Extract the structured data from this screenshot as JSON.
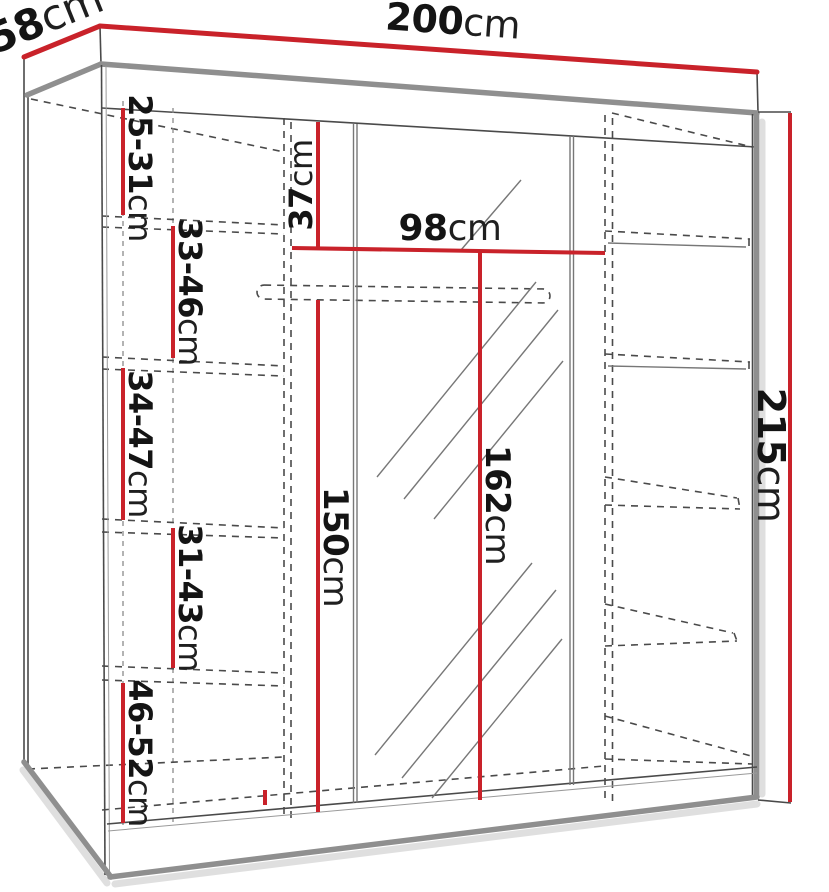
{
  "diagram": {
    "type": "wardrobe-dimension-diagram",
    "accent_color": "#c9222a",
    "line_color": "#141414"
  },
  "labels": {
    "width": {
      "num": "200",
      "unit": "cm"
    },
    "depth": {
      "num": "58",
      "unit": "cm"
    },
    "height": {
      "num": "215",
      "unit": "cm"
    },
    "top_gap": {
      "num": "37",
      "unit": "cm"
    },
    "rod_width": {
      "num": "98",
      "unit": "cm"
    },
    "left_height": {
      "num": "150",
      "unit": "cm"
    },
    "rod_height": {
      "num": "162",
      "unit": "cm"
    },
    "shelf_gap_1": {
      "num": "25-31",
      "unit": "cm"
    },
    "shelf_gap_2": {
      "num": "33-46",
      "unit": "cm"
    },
    "shelf_gap_3": {
      "num": "34-47",
      "unit": "cm"
    },
    "shelf_gap_4": {
      "num": "31-43",
      "unit": "cm"
    },
    "shelf_gap_5": {
      "num": "46-52",
      "unit": "cm"
    }
  }
}
